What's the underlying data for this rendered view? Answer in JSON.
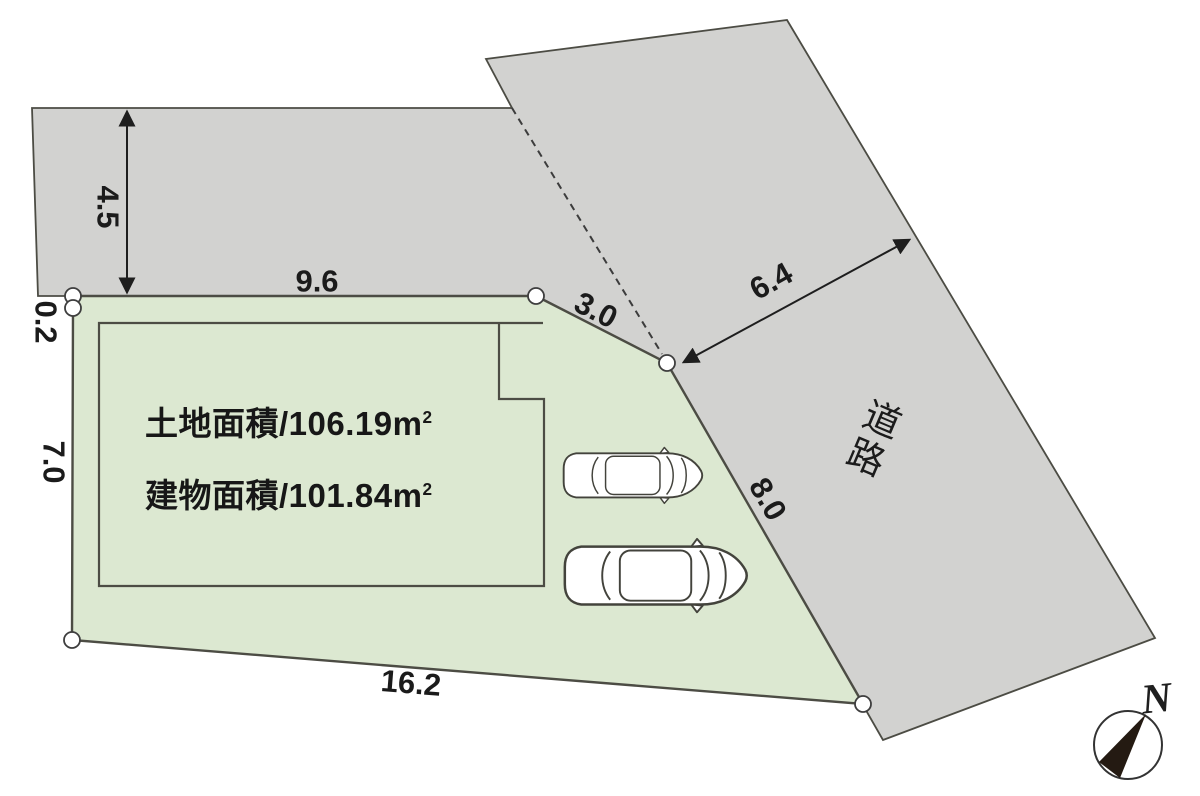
{
  "colors": {
    "background": "#ffffff",
    "land_fill": "#dce8d1",
    "road_fill": "#d2d2d0",
    "outline": "#4c4c44",
    "dimension_text": "#1b1b1b",
    "compass_needle": "#241a12"
  },
  "areas": {
    "land_label": "土地面積",
    "separator": "/",
    "land_value": "106.19",
    "building_label": "建物面積",
    "building_value": "101.84",
    "unit_base": "m",
    "unit_exp": "2"
  },
  "road_label": "道路",
  "compass_label": "N",
  "dimensions": {
    "road_top_width": "4.5",
    "north_edge": "9.6",
    "step_edge": "0.2",
    "west_edge": "7.0",
    "corner_cut": "3.0",
    "road_east_width": "6.4",
    "southeast_edge": "8.0",
    "south_edge": "16.2"
  }
}
